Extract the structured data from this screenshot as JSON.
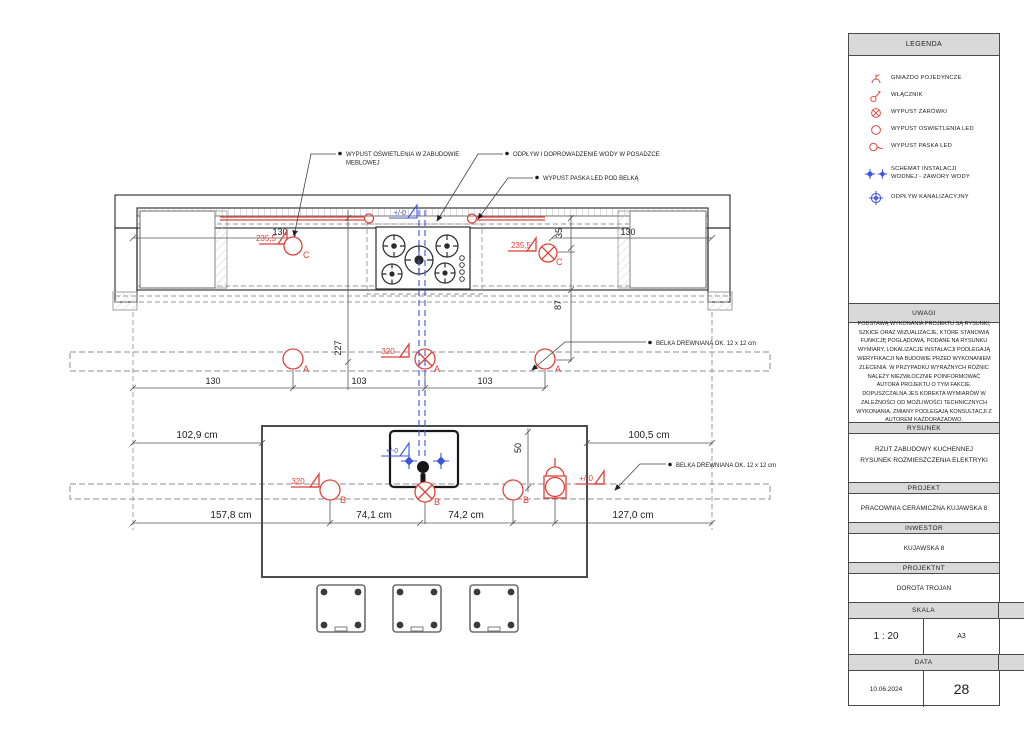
{
  "colors": {
    "red": "#e0423a",
    "blue": "#3d55dd",
    "line": "#3a3a3a",
    "dash": "#979797",
    "hdr": "#d9d9d9"
  },
  "plan": {
    "callouts": {
      "led_cabinet_1": "WYPUST OŚWIETLENIA W ZABUDOWIE",
      "led_cabinet_2": "MEBLOWEJ",
      "water": "ODPŁYW I DOPROWADZENIE WODY W POSADZCE",
      "led_strip": "WYPUST PASKA LED POD BELKĄ",
      "beam_upper": "BELKA DREWNIANA OK. 12 x 12 cm",
      "beam_lower": "BELKA DREWNIANA OK. 12 x 12 cm"
    },
    "levels": {
      "c_left": "235,5",
      "c_right": "235,5",
      "a320_top": "320",
      "a320_island": "320",
      "zero_top": "+/-0",
      "zero_sink": "+/-0",
      "zero_island": "+/-0"
    },
    "markers": {
      "a": "A",
      "b": "B",
      "c": "C"
    },
    "dimensions": {
      "cab_left": "130",
      "cab_right": "130",
      "v35": "35",
      "v87": "87",
      "v227": "227",
      "v50": "50",
      "beam_row": [
        "130",
        "103",
        "103"
      ],
      "island_top": [
        "102,9 cm",
        "100,5 cm"
      ],
      "island_bottom": [
        "157,8 cm",
        "74,1 cm",
        "74,2 cm",
        "127,0 cm"
      ]
    }
  },
  "panel": {
    "legend": {
      "title": "LEGENDA",
      "items": [
        {
          "label": "GNIAZDO POJEDYŃCZE"
        },
        {
          "label": "WŁĄCZNIK"
        },
        {
          "label": "WYPUST ŻARÓWKI"
        },
        {
          "label": "WYPUST OSWIETLENIA LED"
        },
        {
          "label": "WYPUST PASKA LED"
        },
        {
          "label": "SCHEMAT INSTALACJI WODNEJ - ZAWORY WODY"
        },
        {
          "label": "ODPŁYW KANALIZACYJNY"
        }
      ]
    },
    "uwagi": {
      "title": "UWAGI",
      "text": "PODSTAWĄ WYKONANIA PROJEKTU SĄ RYSUNKI, SZKICE ORAZ WIZUALIZACJE, KTÓRE STANOWIĄ FUNKCJĘ POGLĄDOWĄ. PODANE NA RYSUNKU WYMIARY, LOKALIZACJE INSTALACJI PODLEGAJĄ WERYFIKACJI NA BUDOWIE PRZED WYKONANIEM ZLECENIA. W PRZYPADKU WYRAŹNYCH RÓŻNIC NALEŻY NIEZWŁOCZNIE POINFORMOWAĆ AUTORA PROJEKTU O TYM FAKCIE. DOPUSZCZALNA JES KOREKTA WYMIARÓW W ZALEŻNOŚCI OD MOŻLIWOŚCI TECHNICZNYCH WYKONANIA. ZMIANY PODLEGAJĄ KONSULTACJI Z AUTOREM KAŻDORAZAOWO."
    },
    "rysunek": {
      "title": "RYSUNEK",
      "line1": "RZUT ZABUDOWY KUCHENNEJ",
      "line2": "RYSUNEK ROZMIESZCZENIA ELEKTRYKI"
    },
    "projekt": {
      "title": "PROJEKT",
      "value": "PRACOWNIA CERAMICZNA KUJAWSKA 8"
    },
    "inwestor": {
      "title": "INWESTOR",
      "value": "KUJAWSKA 8"
    },
    "projektant": {
      "title": "PROJEKTNT",
      "value": "DOROTA TROJAN"
    },
    "skala": {
      "title": "SKALA",
      "value": "1 : 20"
    },
    "format": {
      "title": "FORMAT",
      "value": "A3"
    },
    "data": {
      "title": "DATA",
      "value": "10.06.2024"
    },
    "strona": {
      "title": "STRONA",
      "value": "28"
    }
  }
}
